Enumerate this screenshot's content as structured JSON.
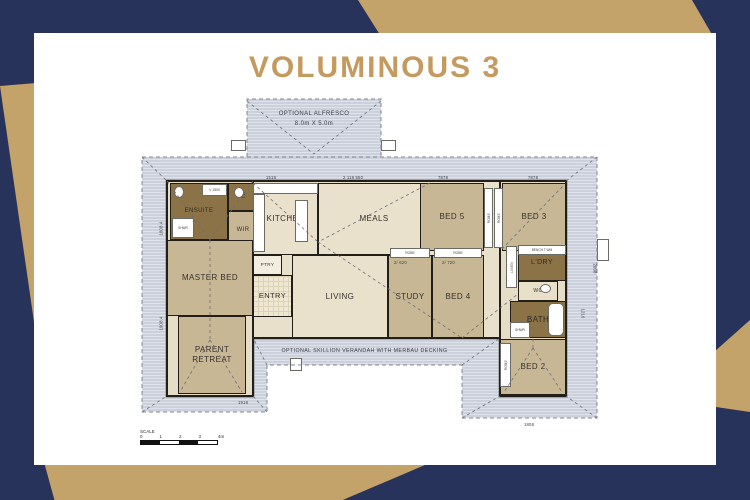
{
  "title": "VOLUMINOUS 3",
  "colors": {
    "background_navy": "#27335A",
    "background_gold": "#C4A36B",
    "title_gold": "#C49A5F",
    "roof_gray": "#CBD0DA",
    "floor_beige": "#E6DDC6",
    "bedroom_tan": "#C8B795",
    "wet_area_brown": "#8C7347",
    "wall_black": "#221E19"
  },
  "alfresco": {
    "line1": "OPTIONAL ALFRESCO",
    "line2": "8.0m X 5.0m"
  },
  "verandah_note": "OPTIONAL SKILLION VERANDAH WITH MERBAU DECKING",
  "scale": {
    "label": "SCALE",
    "ticks": [
      "0",
      "1",
      "2",
      "3",
      "4m"
    ]
  },
  "rooms": [
    {
      "id": "base-left",
      "label": "",
      "x": 29,
      "y": 85,
      "w": 86,
      "h": 215,
      "fill": "#E6DDC6",
      "fs": 7
    },
    {
      "id": "base-mid",
      "label": "",
      "x": 115,
      "y": 85,
      "w": 247,
      "h": 157,
      "fill": "#E8E0CA",
      "fs": 7
    },
    {
      "id": "base-right",
      "label": "",
      "x": 362,
      "y": 85,
      "w": 66,
      "h": 215,
      "fill": "#E6DDC6",
      "fs": 7
    },
    {
      "id": "ensuite",
      "label": "ENSUITE",
      "x": 32,
      "y": 87,
      "w": 58,
      "h": 57,
      "fill": "#8C7347",
      "fs": 6,
      "color": "#2E2A22"
    },
    {
      "id": "wc-ensuite",
      "label": "WC",
      "x": 90,
      "y": 87,
      "w": 26,
      "h": 28,
      "fill": "#8C7347",
      "fs": 5,
      "color": "#2E2A22"
    },
    {
      "id": "wir",
      "label": "WIR",
      "x": 90,
      "y": 115,
      "w": 30,
      "h": 40,
      "fill": "#C8B795",
      "fs": 6
    },
    {
      "id": "master-bed",
      "label": "MASTER BED",
      "x": 29,
      "y": 144,
      "w": 86,
      "h": 76,
      "fill": "#C8B795",
      "fs": 8
    },
    {
      "id": "parent-retreat",
      "label": "PARENT\nRETREAT",
      "x": 40,
      "y": 220,
      "w": 68,
      "h": 78,
      "fill": "#C8B795",
      "fs": 8
    },
    {
      "id": "kitchen",
      "label": "KITCHEN",
      "x": 115,
      "y": 87,
      "w": 65,
      "h": 72,
      "fill": "#E9E1CB",
      "fs": 8
    },
    {
      "id": "meals",
      "label": "MEALS",
      "x": 180,
      "y": 87,
      "w": 112,
      "h": 72,
      "fill": "#E9E1CB",
      "fs": 8
    },
    {
      "id": "ptry",
      "label": "PTRY",
      "x": 115,
      "y": 159,
      "w": 29,
      "h": 20,
      "fill": "#F3EDE0",
      "fs": 4.6
    },
    {
      "id": "entry",
      "label": "ENTRY",
      "x": 115,
      "y": 179,
      "w": 39,
      "h": 42,
      "fill": "#EFE7D2",
      "fs": 7.5,
      "tile": true
    },
    {
      "id": "living",
      "label": "LIVING",
      "x": 154,
      "y": 159,
      "w": 96,
      "h": 83,
      "fill": "#E9E1CB",
      "fs": 8
    },
    {
      "id": "study",
      "label": "STUDY",
      "x": 250,
      "y": 159,
      "w": 44,
      "h": 83,
      "fill": "#C8B795",
      "fs": 8
    },
    {
      "id": "bed4",
      "label": "BED 4",
      "x": 294,
      "y": 159,
      "w": 52,
      "h": 83,
      "fill": "#C8B795",
      "fs": 8
    },
    {
      "id": "bed5",
      "label": "BED 5",
      "x": 282,
      "y": 87,
      "w": 64,
      "h": 68,
      "fill": "#C8B795",
      "fs": 8
    },
    {
      "id": "bed3",
      "label": "BED 3",
      "x": 364,
      "y": 87,
      "w": 64,
      "h": 68,
      "fill": "#C8B795",
      "fs": 8
    },
    {
      "id": "ldry",
      "label": "L'DRY",
      "x": 380,
      "y": 149,
      "w": 48,
      "h": 36,
      "fill": "#8C7347",
      "fs": 7,
      "color": "#2E2A22"
    },
    {
      "id": "wc-right",
      "label": "WC",
      "x": 380,
      "y": 185,
      "w": 40,
      "h": 20,
      "fill": "#E9E0C9",
      "fs": 5
    },
    {
      "id": "bath",
      "label": "BATH",
      "x": 372,
      "y": 205,
      "w": 56,
      "h": 37,
      "fill": "#8C7347",
      "fs": 8,
      "color": "#2E2A22"
    },
    {
      "id": "bed2",
      "label": "BED 2",
      "x": 362,
      "y": 243,
      "w": 66,
      "h": 56,
      "fill": "#C8B795",
      "fs": 8
    }
  ],
  "fixtures": [
    {
      "id": "alfresco-post-left",
      "x": 93,
      "y": 44,
      "w": 15,
      "h": 11,
      "text": ""
    },
    {
      "id": "alfresco-post-right",
      "x": 243,
      "y": 44,
      "w": 15,
      "h": 11,
      "text": ""
    },
    {
      "id": "kitchen-bench-top",
      "x": 115,
      "y": 87,
      "w": 65,
      "h": 11,
      "text": ""
    },
    {
      "id": "kitchen-appliances",
      "x": 115,
      "y": 98,
      "w": 12,
      "h": 58,
      "text": ""
    },
    {
      "id": "kitchen-island",
      "x": 157,
      "y": 104,
      "w": 13,
      "h": 42,
      "text": ""
    },
    {
      "id": "ensuite-vanity",
      "x": 64,
      "y": 88,
      "w": 25,
      "h": 12,
      "text": "V 1500",
      "fs": 3.4
    },
    {
      "id": "ensuite-shower",
      "x": 34,
      "y": 122,
      "w": 22,
      "h": 20,
      "text": "SHWR",
      "fs": 3.2
    },
    {
      "id": "toilet-ensuite",
      "x": 36,
      "y": 90,
      "w": 10,
      "h": 12,
      "text": "",
      "oval": true
    },
    {
      "id": "toilet-wc-left",
      "x": 96,
      "y": 91,
      "w": 10,
      "h": 11,
      "text": "",
      "oval": true
    },
    {
      "id": "robe-study",
      "x": 252,
      "y": 152,
      "w": 40,
      "h": 10,
      "text": "ROBE",
      "fs": 3.4
    },
    {
      "id": "robe-bed4",
      "x": 296,
      "y": 152,
      "w": 48,
      "h": 10,
      "text": "ROBE",
      "fs": 3.4
    },
    {
      "id": "robe-bed5",
      "x": 346,
      "y": 92,
      "w": 9,
      "h": 60,
      "text": "ROBE",
      "fs": 3.2,
      "vert": true
    },
    {
      "id": "robe-bed3",
      "x": 356,
      "y": 92,
      "w": 9,
      "h": 60,
      "text": "ROBE",
      "fs": 3.2,
      "vert": true
    },
    {
      "id": "linen",
      "x": 368,
      "y": 150,
      "w": 11,
      "h": 42,
      "text": "LINEN",
      "fs": 3.2,
      "vert": true
    },
    {
      "id": "ldry-bench",
      "x": 380,
      "y": 149,
      "w": 48,
      "h": 10,
      "text": "BENCH  T  WM",
      "fs": 3.2
    },
    {
      "id": "toilet-wc-right",
      "x": 402,
      "y": 188,
      "w": 11,
      "h": 9,
      "text": "",
      "oval": true
    },
    {
      "id": "bath-tub",
      "x": 410,
      "y": 207,
      "w": 16,
      "h": 33,
      "text": "",
      "round": true
    },
    {
      "id": "bath-shower",
      "x": 372,
      "y": 226,
      "w": 20,
      "h": 16,
      "text": "SHWR",
      "fs": 3.2
    },
    {
      "id": "robe-bed2",
      "x": 362,
      "y": 247,
      "w": 11,
      "h": 44,
      "text": "ROBE",
      "fs": 3.2,
      "vert": true
    },
    {
      "id": "verandah-post",
      "x": 152,
      "y": 262,
      "w": 12,
      "h": 13,
      "text": ""
    },
    {
      "id": "window-right",
      "x": 459,
      "y": 143,
      "w": 12,
      "h": 22,
      "text": ""
    }
  ],
  "dims": [
    {
      "text": "1518",
      "x": 128,
      "y": 79
    },
    {
      "text": "2 118 550",
      "x": 205,
      "y": 79
    },
    {
      "text": "7878",
      "x": 300,
      "y": 79
    },
    {
      "text": "7878",
      "x": 390,
      "y": 79
    },
    {
      "text": "1918",
      "x": 100,
      "y": 304
    },
    {
      "text": "1808",
      "x": 386,
      "y": 326
    },
    {
      "text": "1808.4",
      "x": 16,
      "y": 130,
      "rot": -90
    },
    {
      "text": "1908.4",
      "x": 16,
      "y": 225,
      "rot": -90
    },
    {
      "text": "2808",
      "x": 452,
      "y": 170,
      "rot": 90
    },
    {
      "text": "1216",
      "x": 440,
      "y": 215,
      "rot": 90
    },
    {
      "text": "2/ 620",
      "x": 256,
      "y": 164
    },
    {
      "text": "2/ 720",
      "x": 304,
      "y": 164
    }
  ],
  "paths": {
    "roof_outline": "M4,61 L459,61 L459,322 L324,322 L324,269 L129,269 L129,316 L4,316 Z",
    "alfresco_outline": "M109,61 L109,3 L243,3 L243,61",
    "building_outline": "M29,85 L428,85 L428,300 L362,300 L362,242 L115,242 L115,300 L29,300 Z"
  },
  "ridgelines": [
    [
      109,
      5,
      176,
      58
    ],
    [
      243,
      5,
      176,
      58
    ],
    [
      115,
      87,
      180,
      146
    ],
    [
      292,
      87,
      180,
      146
    ],
    [
      180,
      146,
      324,
      242
    ],
    [
      324,
      242,
      380,
      198
    ],
    [
      29,
      85,
      72,
      144
    ],
    [
      115,
      85,
      72,
      144
    ],
    [
      72,
      144,
      72,
      244
    ],
    [
      72,
      244,
      42,
      296
    ],
    [
      72,
      244,
      104,
      296
    ],
    [
      364,
      153,
      426,
      89
    ],
    [
      395,
      252,
      366,
      296
    ],
    [
      395,
      252,
      424,
      296
    ],
    [
      395,
      252,
      395,
      228
    ],
    [
      4,
      61,
      29,
      85
    ],
    [
      459,
      61,
      428,
      85
    ],
    [
      4,
      316,
      29,
      300
    ],
    [
      459,
      322,
      428,
      300
    ],
    [
      129,
      269,
      115,
      242
    ],
    [
      324,
      269,
      362,
      242
    ],
    [
      129,
      316,
      115,
      300
    ],
    [
      324,
      322,
      362,
      300
    ]
  ]
}
